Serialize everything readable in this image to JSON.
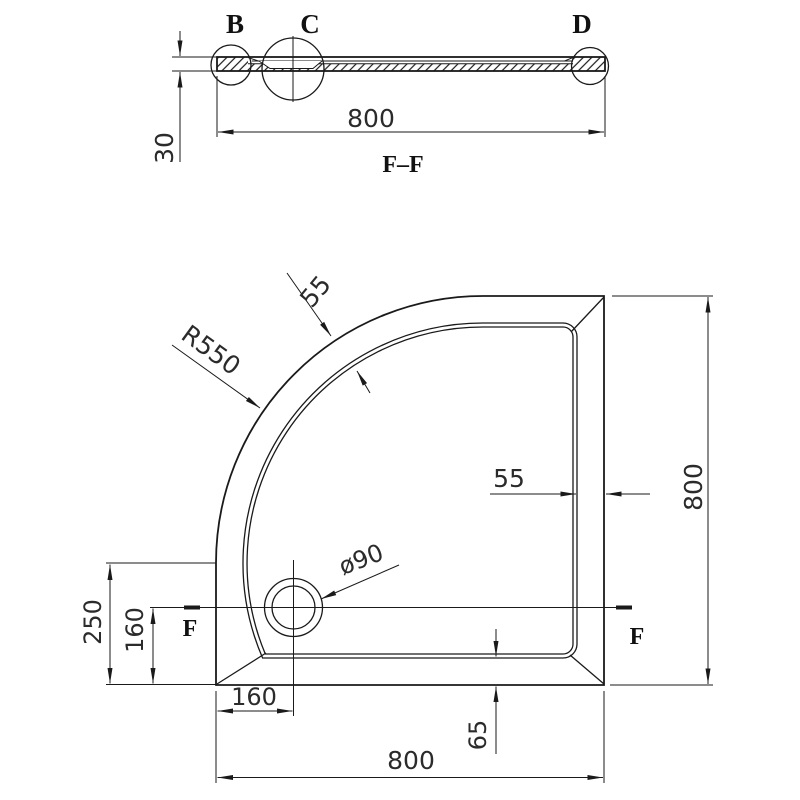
{
  "section_view": {
    "detail_label_b": "B",
    "detail_label_c": "C",
    "detail_label_d": "D",
    "dim_overall_width": "800",
    "dim_thickness": "30",
    "title": "F–F"
  },
  "plan_view": {
    "dim_corner_radius": "R550",
    "dim_rim_width_arc": "55",
    "dim_rim_width_right": "55",
    "dim_overall_height": "800",
    "dim_overall_width": "800",
    "dim_drain_offset_x": "160",
    "dim_drain_offset_y": "160",
    "dim_left_straight_edge": "250",
    "dim_bottom_rim_inset": "65",
    "dim_drain_diameter": "ø90",
    "section_marker_left": "F",
    "section_marker_right": "F"
  },
  "colors": {
    "line": "#1a1a1a",
    "background": "#ffffff"
  }
}
